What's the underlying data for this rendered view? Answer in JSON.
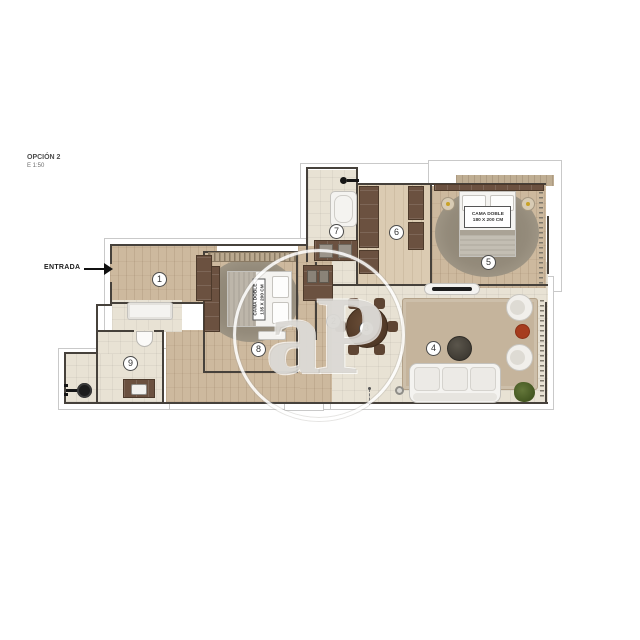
{
  "header": {
    "option_label": "OPCIÓN 2",
    "scale_label": "E 1:50"
  },
  "entrance": {
    "label": "ENTRADA"
  },
  "watermark": {
    "text": "aP"
  },
  "rooms": [
    {
      "n": "1"
    },
    {
      "n": "2"
    },
    {
      "n": "3"
    },
    {
      "n": "4"
    },
    {
      "n": "5"
    },
    {
      "n": "6"
    },
    {
      "n": "7"
    },
    {
      "n": "8"
    },
    {
      "n": "9"
    }
  ],
  "beds": {
    "master": {
      "line1": "CAMA DOBLE",
      "line2": "180 X 200 CM"
    },
    "second": {
      "line1": "CAMA DOBLE",
      "line2": "135 X 200 CM"
    }
  },
  "colors": {
    "wood_floor": "#cdb99e",
    "tile_floor": "#e8e2d4",
    "living_rug": "#c5b49c",
    "gray_rug": "#948b7b",
    "furniture_brown": "#6b5140",
    "dining_table_brown": "#583f2e",
    "accent_red_table": "#a63c1e",
    "plant_green": "#55682f",
    "wall_dark": "#46413b",
    "outline_gray": "#c9c9c9"
  }
}
